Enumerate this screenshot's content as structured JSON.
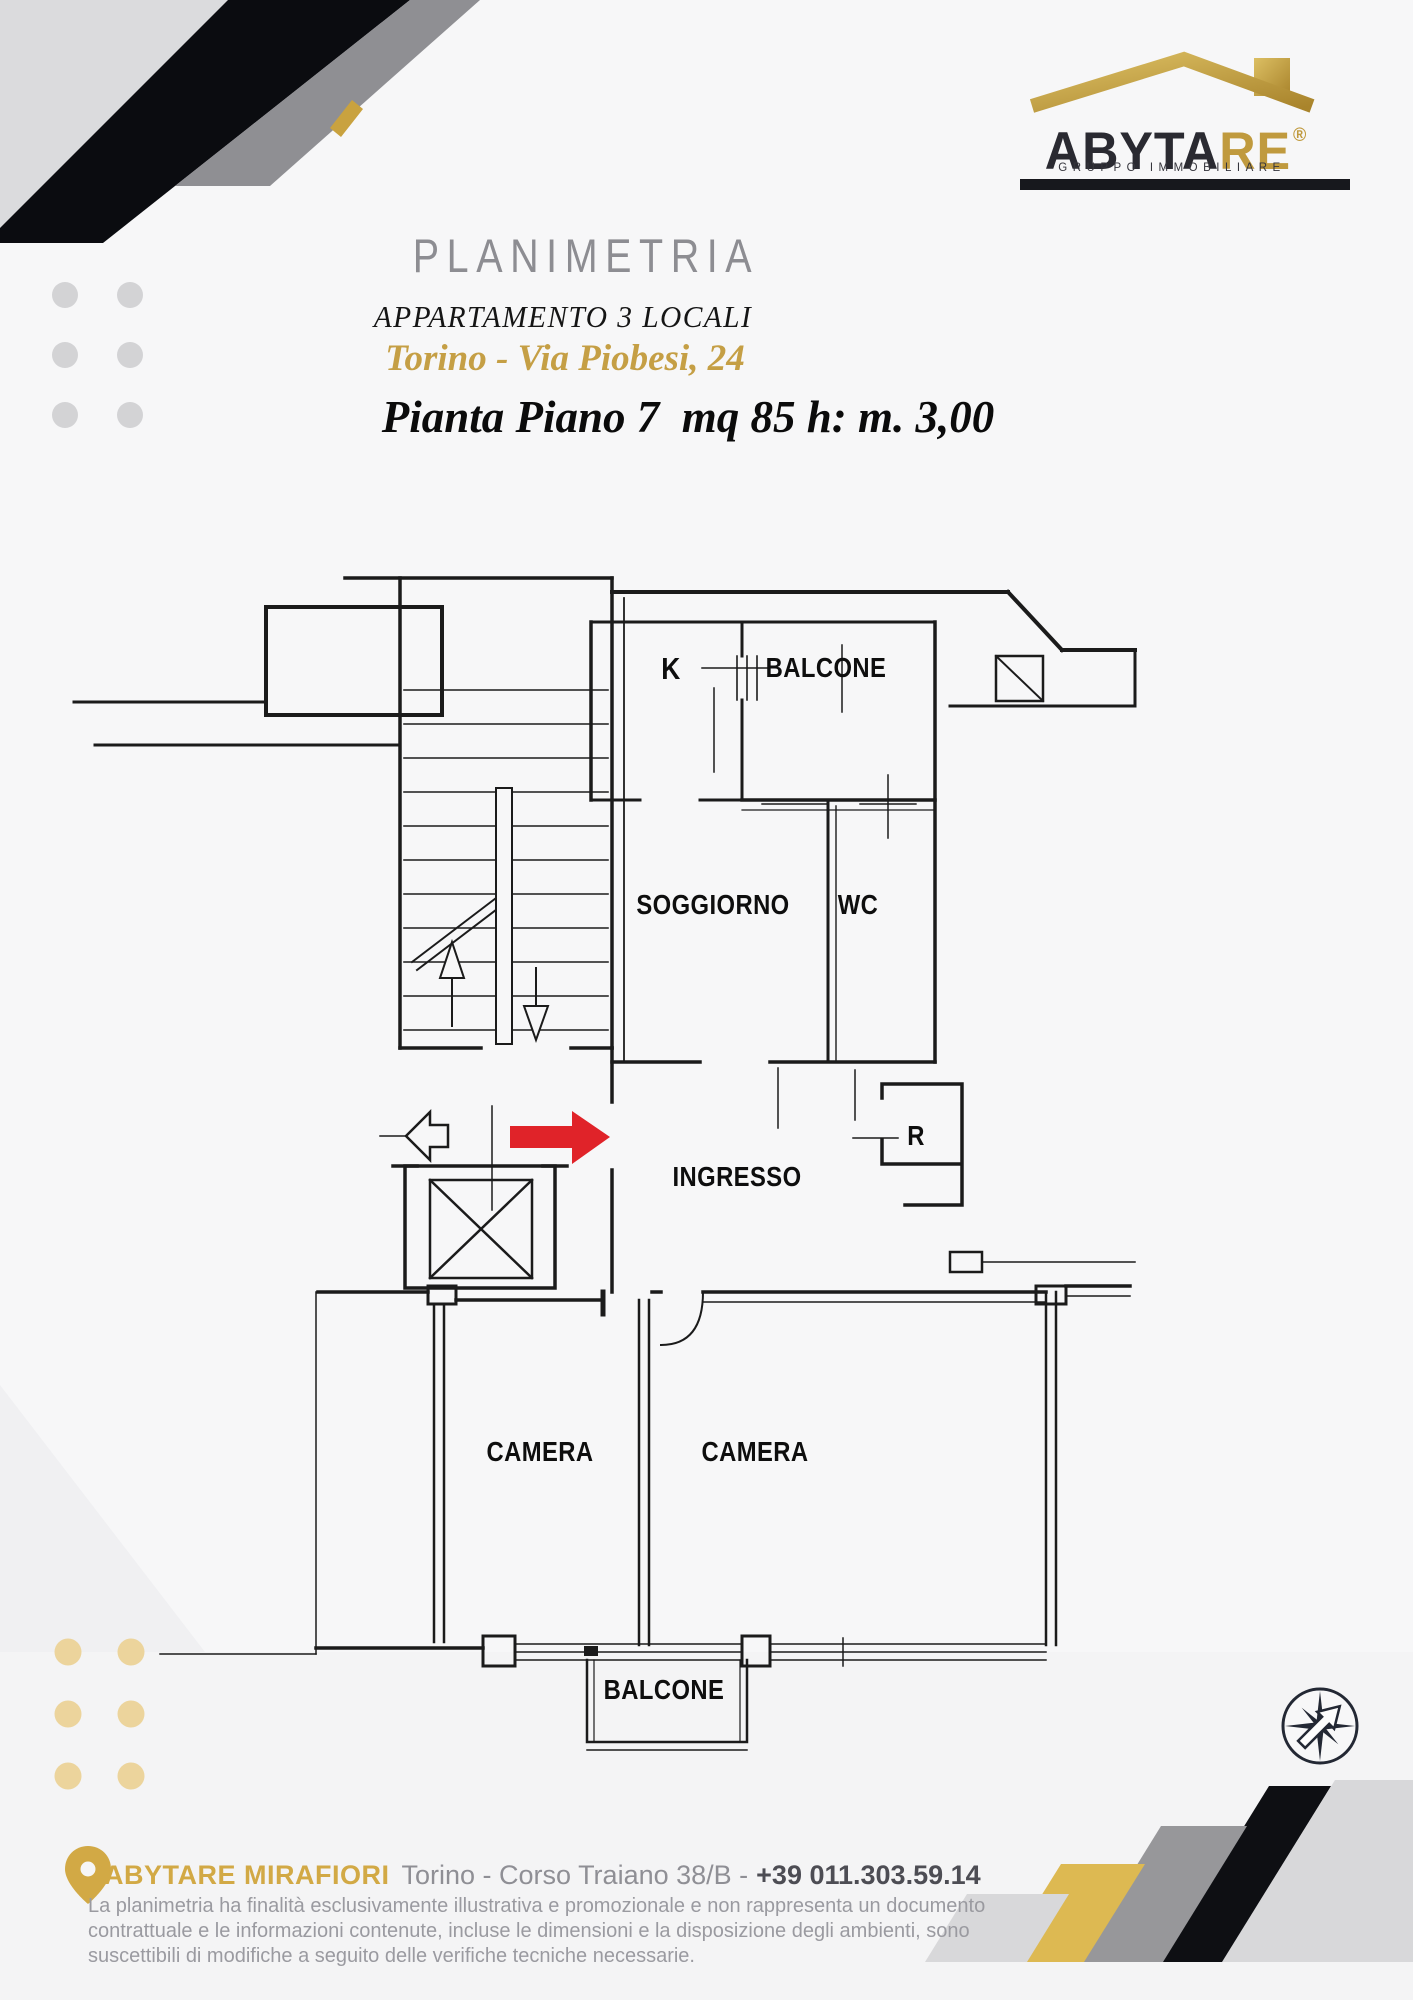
{
  "logo": {
    "brand_prefix": "ABYTA",
    "brand_suffix": "RE",
    "registered": "®",
    "tagline": "GRUPPO IMMOBILIARE"
  },
  "header": {
    "title": "PLANIMETRIA",
    "subtitle": "APPARTAMENTO 3 LOCALI",
    "address": "Torino - Via Piobesi, 24",
    "plan_info": "Pianta Piano 7  mq 85 h: m. 3,00"
  },
  "floor_plan": {
    "rooms": {
      "kitchen": "K",
      "balcony_top": "BALCONE",
      "living_room": "SOGGIORNO",
      "wc": "WC",
      "entrance": "INGRESSO",
      "storage": "R",
      "bedroom_left": "CAMERA",
      "bedroom_right": "CAMERA",
      "balcony_bottom": "BALCONE"
    }
  },
  "footer": {
    "agency": "ABYTARE MIRAFIORI",
    "address": "Torino - Corso Traiano 38/B -",
    "phone": "+39 011.303.59.14",
    "disclaimer_lines": [
      "La planimetria ha finalità esclusivamente illustrativa e promozionale e non rappresenta un documento",
      "contrattuale e le informazioni contenute, incluse le dimensioni e la disposizione degli ambienti, sono",
      "suscettibili di modifiche a seguito delle verifiche tecniche necessarie."
    ]
  },
  "colors": {
    "brand_gold": "#c09a3e",
    "title_gray": "#8d8d92",
    "address_gold": "#c59f45",
    "footer_gold": "#d2a945",
    "plan_line": "#1b1b1b",
    "entrance_arrow_red": "#e02329",
    "decor_black": "#0b0c10",
    "decor_gray": "#8f8f93",
    "decor_light": "#dbdbdd",
    "background": "#f7f7f8"
  }
}
